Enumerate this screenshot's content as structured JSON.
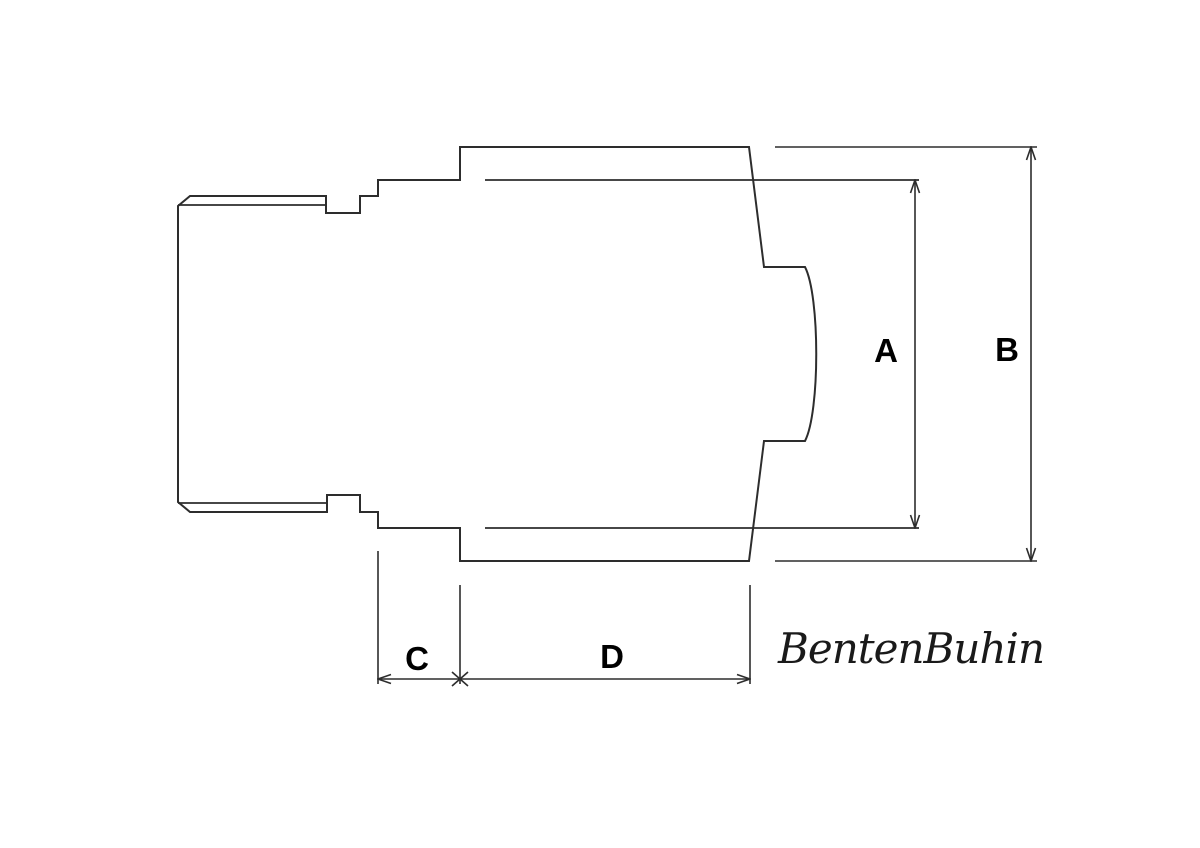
{
  "drawing": {
    "watermark": "BentenBuhin",
    "dimension_labels": {
      "a": "A",
      "b": "B",
      "c": "C",
      "d": "D"
    },
    "colors": {
      "background": "#ffffff",
      "line": "#2d2d2d",
      "label_text": "#000000"
    }
  }
}
